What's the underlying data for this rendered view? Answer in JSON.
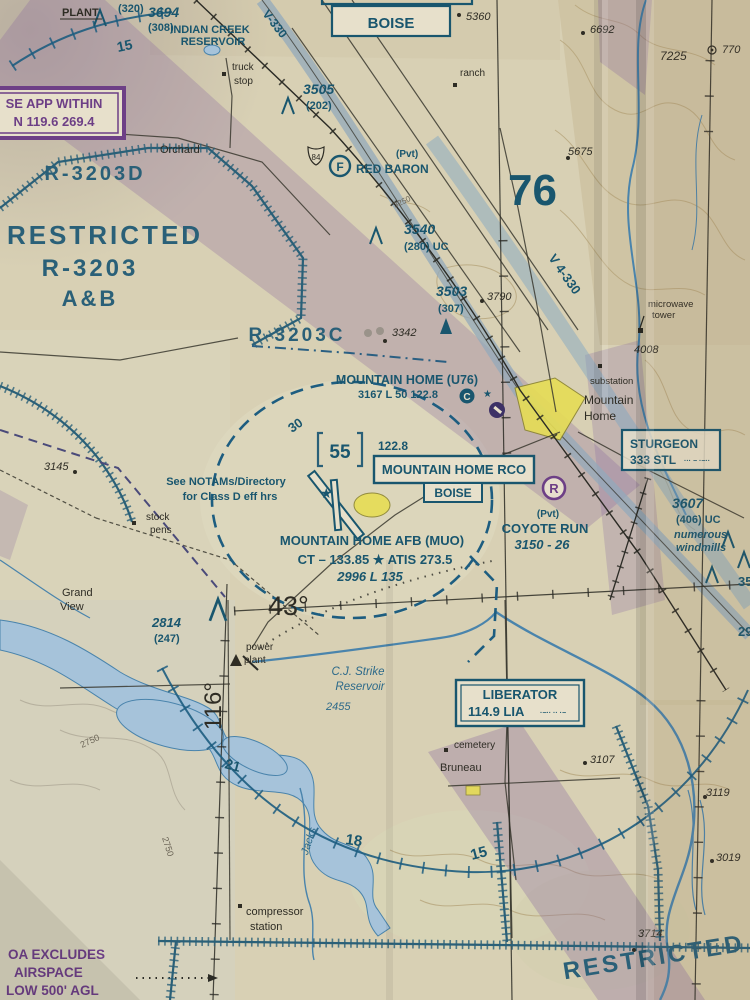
{
  "palette": {
    "chart_blue": "#19566e",
    "boundary_blue": "#2a6078",
    "magenta_purple": "#6d3f86",
    "moa_purple": "#8a6aa0",
    "city_yellow": "#e6dd55",
    "water_blue": "#a6c3da",
    "paper": "#d8d0b4"
  },
  "top": {
    "plant": "PLANT",
    "agl_320": "(320)",
    "elev_3694": "3694",
    "agl_3694": "(308)",
    "indian_creek_1": "INDIAN CREEK",
    "indian_creek_2": "RESERVOIR",
    "compass_15": "15",
    "app_box_1": "SE APP WITHIN",
    "app_box_2": "N 119.6 269.4",
    "truck_1": "truck",
    "truck_2": "stop",
    "boise_box": "BOISE",
    "spot_5360": "5360",
    "ranch": "ranch",
    "obst_3505": "3505",
    "obst_3505_agl": "(202)",
    "airway_v330": "V-330",
    "spot_6692": "6692",
    "spot_7225": "7225",
    "spot_770": "770",
    "spot_5675": "5675"
  },
  "restricted": {
    "d": "R-3203D",
    "line1": "RESTRICTED",
    "line2": "R-3203",
    "line3": "A&B",
    "c": "R-3203C",
    "bottom": "RESTRICTED"
  },
  "mid": {
    "orchard": "Orchard",
    "shield_84": "84",
    "red_baron_pvt": "(Pvt)",
    "red_baron": "RED BARON",
    "red_baron_sym": "F",
    "mef_76": "76",
    "airway_v4330": "V 4-330",
    "obst_3540": "3540",
    "obst_3540_agl": "(280) UC",
    "contour_3250": "3250",
    "obst_3503": "3503",
    "obst_3503_agl": "(307)",
    "spot_3790": "3790",
    "spot_3342": "3342",
    "microwave_1": "microwave",
    "microwave_2": "tower",
    "spot_4008": "4008",
    "muni_name": "MOUNTAIN HOME (U76)",
    "muni_data": "3167 L 50 122.8",
    "muni_sym": "C",
    "town_1": "Mountain",
    "town_2": "Home",
    "substation": "substation",
    "sturgeon_1": "STURGEON",
    "sturgeon_2": "333 STL",
    "sturgeon_morse": "··· − ·−··",
    "compass_30": "30",
    "class_d_ceiling": "55",
    "ctaf": "122.8",
    "rco_1": "MOUNTAIN HOME RCO",
    "rco_2": "BOISE",
    "coyote_sym": "R",
    "coyote_pvt": "(Pvt)",
    "coyote_name": "COYOTE RUN",
    "coyote_data": "3150 - 26",
    "obst_3607": "3607",
    "obst_3607_agl": "(406) UC",
    "windmills_1": "numerous",
    "windmills_2": "windmills",
    "cut_35": "35",
    "cut_29": "29",
    "notam_1": "See NOTAMs/Directory",
    "notam_2": "for Class D eff hrs",
    "stock_1": "stock",
    "stock_2": "pens",
    "spot_3145": "3145",
    "afb_name": "MOUNTAIN HOME AFB (MUO)",
    "afb_freq": "CT – 133.85 ★ ATIS 273.5",
    "afb_data": "2996 L 135"
  },
  "south": {
    "lat_43": "43°",
    "lon_116": "116°",
    "grand_1": "Grand",
    "grand_2": "View",
    "obst_2814": "2814",
    "obst_2814_agl": "(247)",
    "power_1": "power",
    "power_2": "plant",
    "reservoir_1": "C.J. Strike",
    "reservoir_2": "Reservoir",
    "res_elev": "2455",
    "liberator_1": "LIBERATOR",
    "liberator_2": "114.9 LIA",
    "liberator_morse": "·−·· ·· ·−",
    "cemetery": "cemetery",
    "bruneau": "Bruneau",
    "spot_3107": "3107",
    "compass_21": "21",
    "compass_18": "18",
    "compass_15": "15",
    "jacks": "Jacks",
    "contour_2750a": "2750",
    "contour_2750b": "2750",
    "compressor_1": "compressor",
    "compressor_2": "station",
    "moa_1": "OA EXCLUDES",
    "moa_2": "AIRSPACE",
    "moa_3": "LOW 500' AGL",
    "spot_3714": "3714",
    "spot_3019": "3019",
    "spot_3119": "3119"
  }
}
